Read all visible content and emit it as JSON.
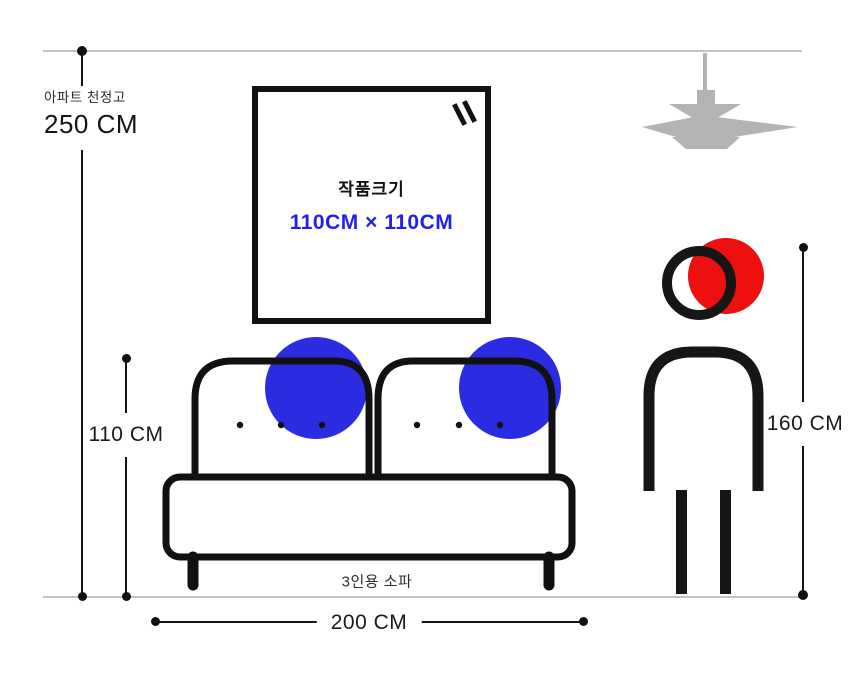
{
  "scene": {
    "ceiling": {
      "label": "아파트 천정고",
      "value": "250 CM"
    },
    "artwork": {
      "title": "작품크기",
      "size": "110CM × 110CM"
    },
    "sofa": {
      "label": "3인용 소파",
      "height": "110 CM",
      "width": "200 CM"
    },
    "person": {
      "height": "160 CM"
    }
  },
  "colors": {
    "accent_blue": "#2b2be2",
    "accent_red": "#ee0f0f",
    "artwork_size_text": "#1f1ff0",
    "ink": "#111111",
    "lamp_gray": "#b3b3b3",
    "guide_line_gray": "#c3c3c3"
  }
}
